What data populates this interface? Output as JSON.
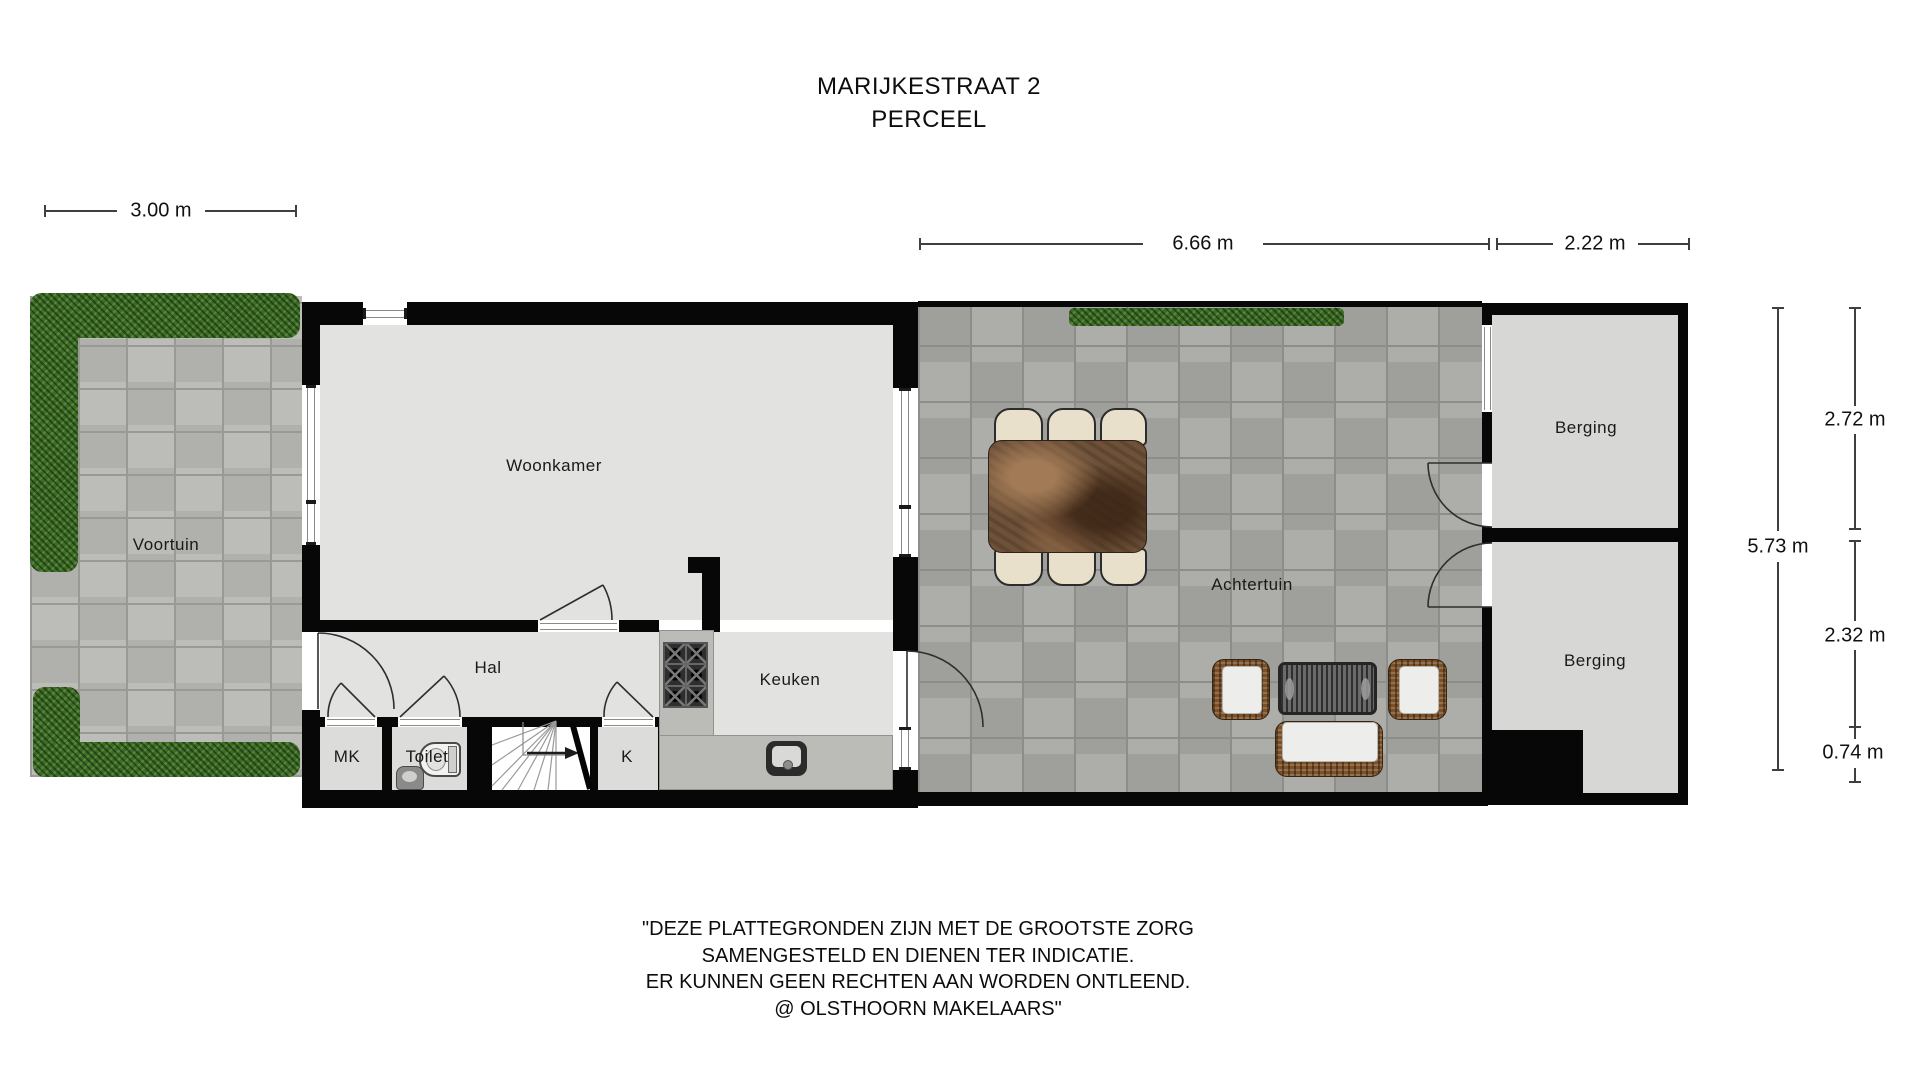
{
  "title": {
    "line1": "MARIJKESTRAAT 2",
    "line2": "PERCEEL"
  },
  "dimensions": {
    "front_width": "3.00 m",
    "garden_width": "6.66 m",
    "shed_width": "2.22 m",
    "right_total_depth": "5.73 m",
    "shed_top_depth": "2.72 m",
    "shed_bottom_depth": "2.32 m",
    "shed_notch_depth": "0.74 m"
  },
  "rooms": {
    "front_garden": "Voortuin",
    "living_room": "Woonkamer",
    "hall": "Hal",
    "meter_closet": "MK",
    "toilet": "Toilet",
    "closet": "K",
    "kitchen": "Keuken",
    "back_garden": "Achtertuin",
    "shed_top": "Berging",
    "shed_bottom": "Berging"
  },
  "disclaimer": {
    "line1": "\"DEZE PLATTEGRONDEN ZIJN MET DE GROOTSTE ZORG",
    "line2": "SAMENGESTELD EN DIENEN TER INDICATIE.",
    "line3": "ER KUNNEN GEEN RECHTEN AAN WORDEN ONTLEEND.",
    "line4": "@ OLSTHOORN MAKELAARS\""
  },
  "colors": {
    "wall": "#070707",
    "room_fill": "#e2e2e1",
    "shed_fill": "#d7d7d5",
    "front_paving": "#b7b7b3",
    "back_paving": "#a8a8a4",
    "hedge_green": "#3e6b28",
    "counter_gray": "#bbbbb8",
    "table_brown": "#6e5138",
    "chair_cream": "#e8e0cb",
    "wicker_brown": "#7c5128",
    "dimension_line": "#3f3f3f"
  }
}
